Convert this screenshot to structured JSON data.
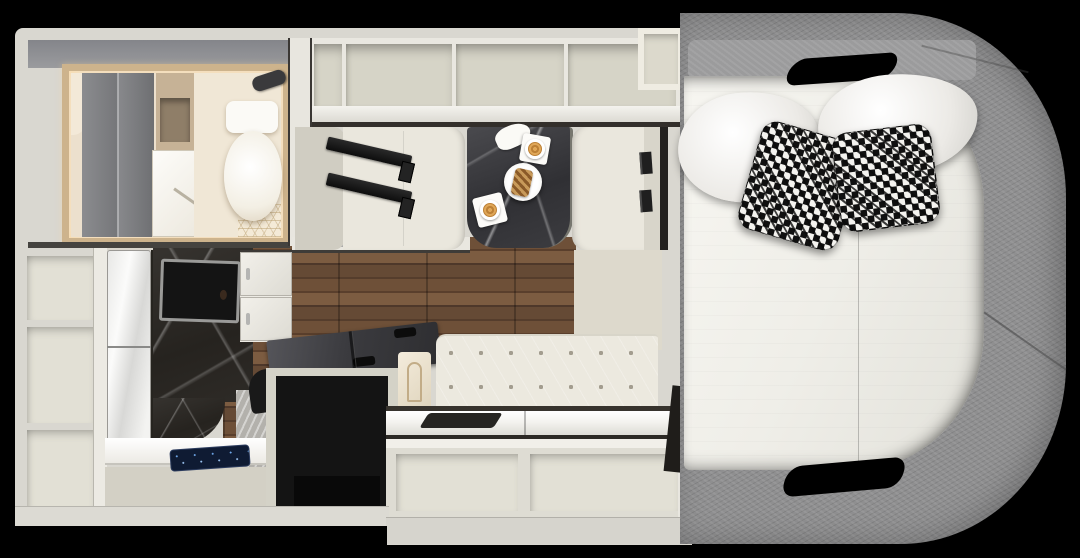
{
  "scene": {
    "type": "top-down 3d rendered camper floor plan",
    "background_color": "#000000",
    "labels": {
      "floorplan": "RV camper interior floor plan seen from above",
      "wet_bath": "wet bath with wardrobe doors, shelf unit, shower door and toilet",
      "overhead_cabinets": "row of four open overhead cabinet bays",
      "entry_wall": "entry wall with step ledge and grab rail",
      "dinette": "face-to-face dinette with two cream benches and seat belts",
      "table": "dark marble dinette table with two cappuccinos, pastry plate and napkin",
      "wardrobe_tower": "open shelf tower with three cubbies",
      "refrigerator": "glossy white two-door refrigerator",
      "shower_column": "dark marble shower column with smoked glass window",
      "wall_cabinet": "white two-door wall cabinet",
      "galley_counter": "galley counter with dark blue cooktop control panel",
      "kitchen_island": "kitchen unit with smoked glass flip-up covers and black appliance front",
      "sofa": "cream button-tufted sofa bench",
      "rear_counter": "glossy white rear counter with recessed dark tray",
      "storage_cubbies": "open storage cubbies under rear counter",
      "bed": "rear bed with gray upholstered wrap-around surround",
      "mattress": "white mattress with center seam",
      "pillows": "two white pillows and two black-and-white houndstooth pillows",
      "handle_cutouts": "hand-hold cutouts in the gray bed surround"
    },
    "counts": {
      "overhead_cabinet_bays": 4,
      "shelf_tower_cubbies": 3,
      "rear_storage_cubbies": 2,
      "white_pillows": 2,
      "houndstooth_pillows": 2,
      "seat_belts": 2,
      "coffee_cups": 2
    },
    "palette": {
      "wall": "#d9d7d0",
      "cabinet_interior": "#d6d4c7",
      "cushion_cream": "#eae7dd",
      "wood_floor_dark": "#4e382a",
      "wood_floor_light": "#7c5c41",
      "table_marble": "#36363a",
      "shower_marble": "#2b2824",
      "bed_surround_gray": "#8f8f90",
      "mattress_white": "#f1f0ea",
      "appliance_black": "#141414",
      "control_panel_navy": "#0f1b33",
      "skylight_frame_tan": "#cdb38c",
      "coffee_tan": "#d0913f"
    }
  }
}
